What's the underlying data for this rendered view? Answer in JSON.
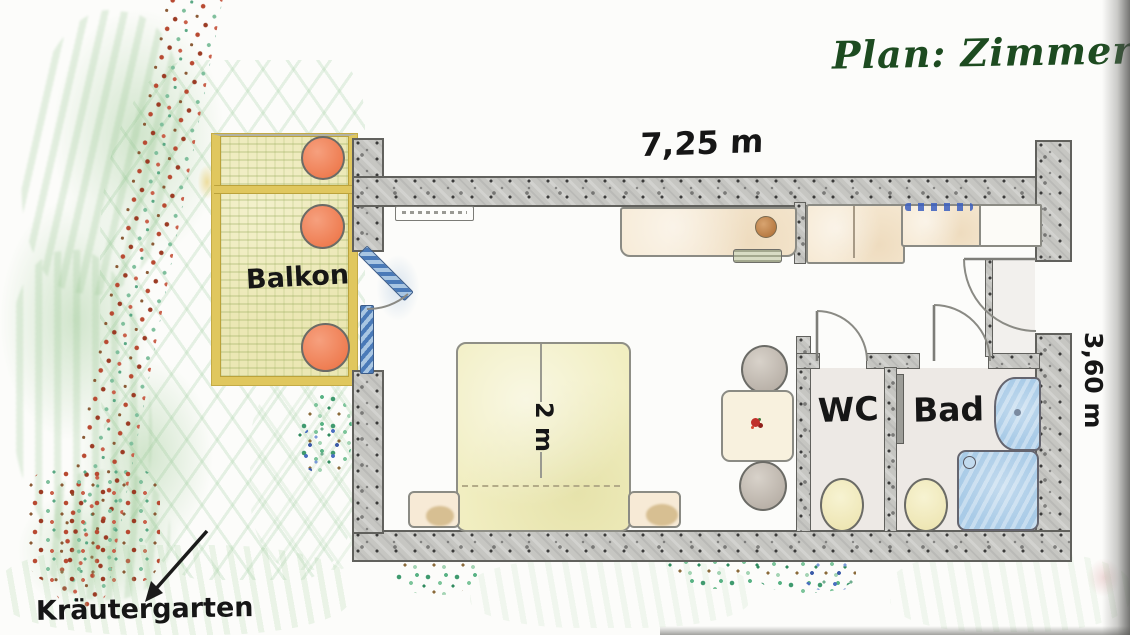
{
  "title": "Plan: Zimmer",
  "labels": {
    "top_dimension": "7,25 m",
    "right_dimension": "3,60 m",
    "bed_width": "2 m",
    "balcony": "Balkon",
    "wc": "WC",
    "bathroom": "Bad",
    "herb_garden": "Kräutergarten"
  },
  "colors": {
    "title_green": "#1d4b20",
    "wall_gray": "#c6c6c2",
    "balcony_rail_yellow": "#e0c75e",
    "balcony_table_orange": "#ee7a4e",
    "bed_yellow": "#f1eec1",
    "furniture_beige": "#f6e9d3",
    "sanitary_blue": "#a9cbe7",
    "glass_door_blue": "#4a7ab8",
    "garden_green": "#7fbf9c",
    "hedge_red": "#b84a32"
  }
}
